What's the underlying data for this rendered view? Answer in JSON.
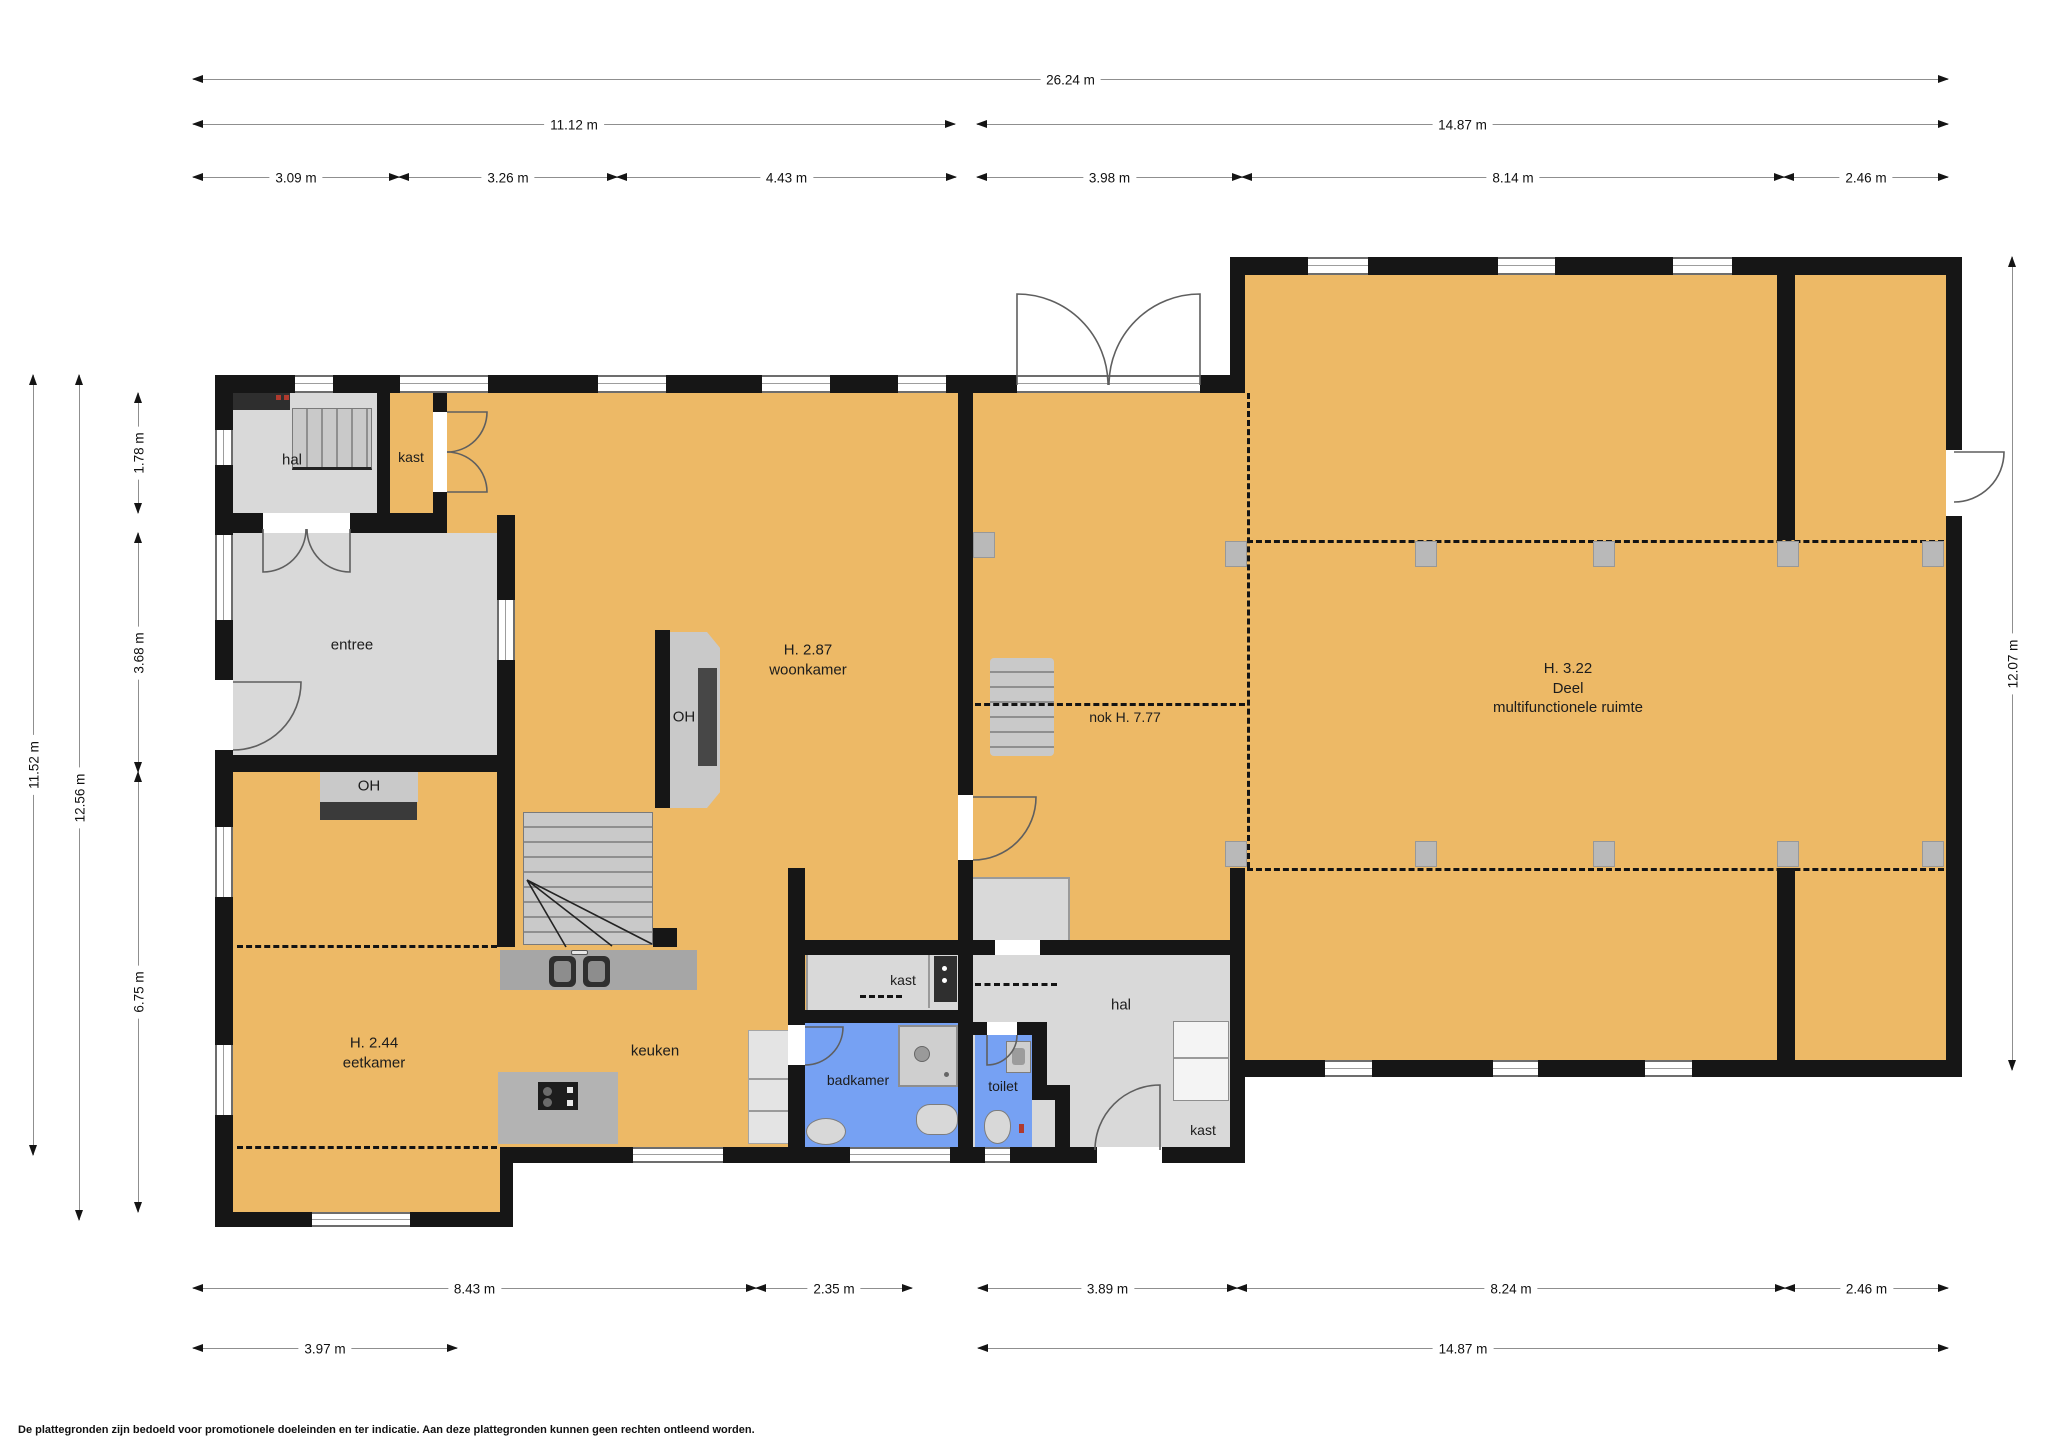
{
  "disclaimer": "De plattegronden zijn bedoeld voor promotionele doeleinden en ter indicatie. Aan deze plattegronden kunnen geen rechten ontleend worden.",
  "colors": {
    "wall": "#161616",
    "floor_main": "#edb966",
    "floor_secondary": "#d9d9d9",
    "floor_wet": "#76a1f3",
    "dimension_line": "#8f8f8f"
  },
  "dimensions": {
    "top": {
      "row1": [
        "26.24 m"
      ],
      "row2": [
        "11.12 m",
        "14.87 m"
      ],
      "row3": [
        "3.09 m",
        "3.26 m",
        "4.43 m",
        "3.98 m",
        "8.14 m",
        "2.46 m"
      ]
    },
    "bottom": {
      "row1": [
        "8.43 m",
        "2.35 m",
        "3.89 m",
        "8.24 m",
        "2.46 m"
      ],
      "row2": [
        "3.97 m",
        "14.87 m"
      ]
    },
    "left": [
      "11.52 m",
      "12.56 m",
      "1.78 m",
      "3.68 m",
      "6.75 m"
    ],
    "right": [
      "12.07 m"
    ]
  },
  "rooms": {
    "hal_top": "hal",
    "kast_top": "kast",
    "entree": "entree",
    "woonkamer_height": "H. 2.87",
    "woonkamer": "woonkamer",
    "fireplace_label": "OH",
    "eetkamer_height": "H. 2.44",
    "eetkamer": "eetkamer",
    "keuken": "keuken",
    "badkamer": "badkamer",
    "toilet": "toilet",
    "hal_lower": "hal",
    "kast_boiler": "kast",
    "kast_lower": "kast",
    "nok": "nok H. 7.77",
    "deel_height": "H. 3.22",
    "deel_line1": "Deel",
    "deel_line2": "multifunctionele ruimte"
  }
}
